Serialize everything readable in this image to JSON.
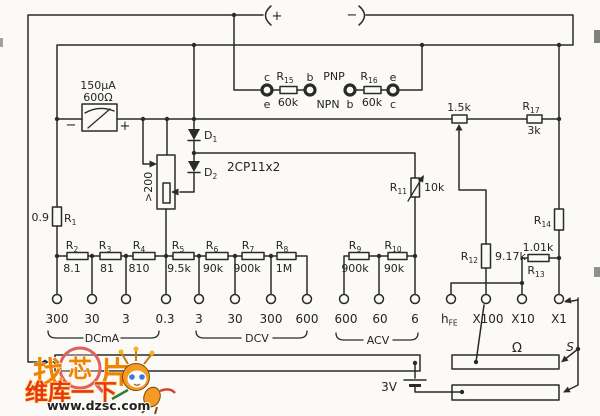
{
  "jacks": {
    "plus": "+",
    "minus": "−"
  },
  "meter": {
    "rating": "150μA",
    "resistance": "600Ω",
    "neg": "−",
    "pos": "+"
  },
  "transistor_test": {
    "s1_top": "c",
    "s1_bot": "e",
    "r15": {
      "name": "R",
      "sub": "15",
      "value": "60k"
    },
    "s2_top": "b",
    "pnp": "PNP",
    "npn": "NPN",
    "s3_bot": "b",
    "r16": {
      "name": "R",
      "sub": "16",
      "value": "60k"
    },
    "s4_top": "e",
    "s4_bot": "c"
  },
  "adj_pot": {
    "value": "1.5k"
  },
  "r17": {
    "name": "R",
    "sub": "17",
    "value": "3k"
  },
  "diodes": {
    "d1": {
      "name": "D",
      "sub": "1"
    },
    "d2": {
      "name": "D",
      "sub": "2"
    },
    "model": "2CP11x2"
  },
  "shunt_pot": {
    "value": ">200"
  },
  "r1": {
    "value": "0.9",
    "name": "R",
    "sub": "1"
  },
  "r11": {
    "name": "R",
    "sub": "11",
    "value": "10k"
  },
  "r12": {
    "name": "R",
    "sub": "12",
    "value": "9.17k"
  },
  "r13": {
    "value": "1.01k",
    "name": "R",
    "sub": "13"
  },
  "r14": {
    "name": "R",
    "sub": "14"
  },
  "dc_chain": [
    {
      "name": "R",
      "sub": "2",
      "value": "8.1"
    },
    {
      "name": "R",
      "sub": "3",
      "value": "81"
    },
    {
      "name": "R",
      "sub": "4",
      "value": "810"
    },
    {
      "name": "R",
      "sub": "5",
      "value": "9.5k"
    },
    {
      "name": "R",
      "sub": "6",
      "value": "90k"
    },
    {
      "name": "R",
      "sub": "7",
      "value": "900k"
    },
    {
      "name": "R",
      "sub": "8",
      "value": "1M"
    }
  ],
  "ac_chain": [
    {
      "name": "R",
      "sub": "9",
      "value": "900k"
    },
    {
      "name": "R",
      "sub": "10",
      "value": "90k"
    }
  ],
  "terminals": {
    "dcma": [
      "300",
      "30",
      "3",
      "0.3"
    ],
    "dcv": [
      "3",
      "30",
      "300",
      "600"
    ],
    "acv": [
      "600",
      "60",
      "6"
    ],
    "hfe": {
      "name": "h",
      "sub": "FE"
    },
    "ohm_ranges": [
      "X100",
      "X10",
      "X1"
    ]
  },
  "group_labels": {
    "dcma": "DCmA",
    "dcv": "DCV",
    "acv": "ACV"
  },
  "battery": {
    "label": "3V"
  },
  "ohm_section": {
    "symbol": "Ω",
    "switch": "S"
  },
  "watermark": {
    "char1": "找",
    "char2": "芯",
    "char3": "片",
    "brand": "维库一下",
    "url": "www.dzsc.com"
  }
}
